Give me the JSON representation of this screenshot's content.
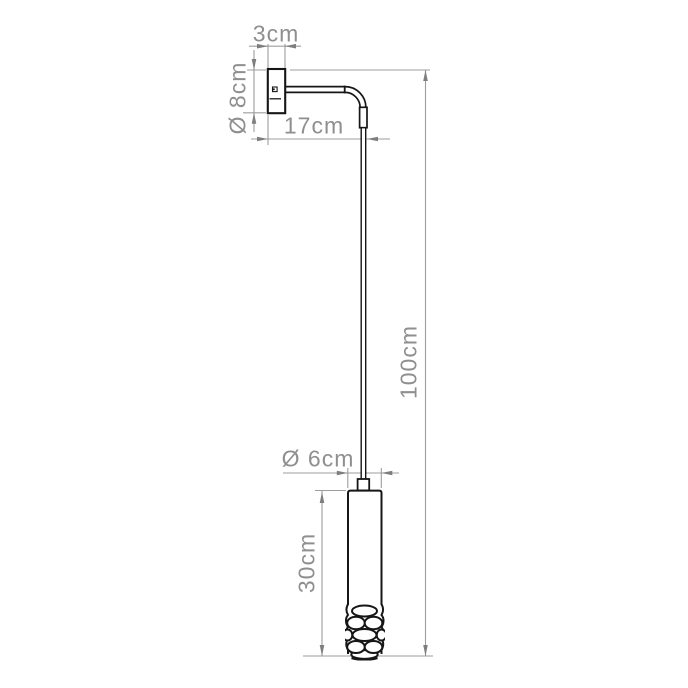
{
  "drawing": {
    "title": "Wall-mounted pendant lamp dimension drawing",
    "dimensions": {
      "bracket_depth": "3cm",
      "bracket_diameter": "Ø 8cm",
      "arm_length": "17cm",
      "overall_height": "100cm",
      "shade_diameter": "Ø 6cm",
      "shade_height": "30cm"
    },
    "colors": {
      "background": "#ffffff",
      "outline": "#161616",
      "dimension_line": "#9d9d9d",
      "arrowhead": "#7e7e7e",
      "dimension_text": "#8f8f8f"
    }
  }
}
